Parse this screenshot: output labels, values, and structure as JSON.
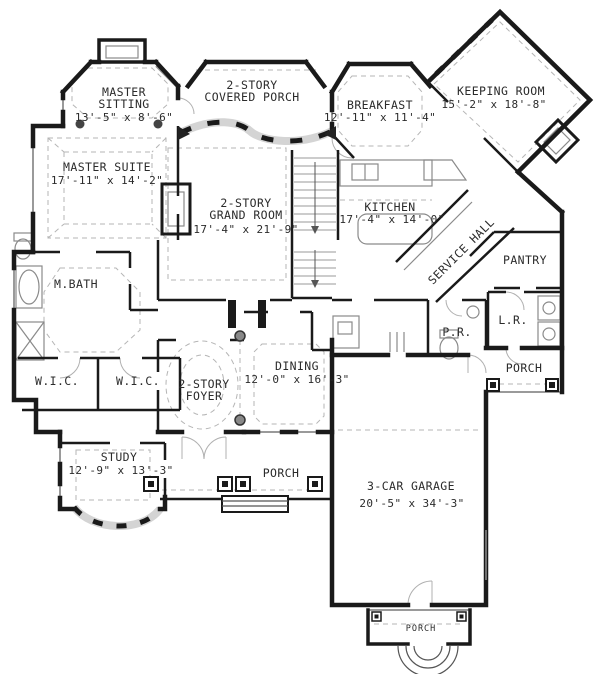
{
  "plan": {
    "type": "first-floor-house-plan",
    "rooms": {
      "master_sitting": {
        "line1": "MASTER",
        "line2": "SITTING",
        "dims": "13'-5\" x 8'-6\""
      },
      "master_suite": {
        "name": "MASTER SUITE",
        "dims": "17'-11\" x 14'-2\""
      },
      "covered_porch": {
        "line1": "2-STORY",
        "line2": "COVERED PORCH"
      },
      "breakfast": {
        "name": "BREAKFAST",
        "dims": "12'-11\" x 11'-4\""
      },
      "keeping_room": {
        "name": "KEEPING ROOM",
        "dims": "15'-2\" x 18'-8\""
      },
      "grand_room": {
        "line1": "2-STORY",
        "line2": "GRAND ROOM",
        "dims": "17'-4\" x 21'-9\""
      },
      "kitchen": {
        "name": "KITCHEN",
        "dims": "17'-4\" x 14'-0\""
      },
      "service_hall": {
        "name": "SERVICE HALL"
      },
      "pantry": {
        "name": "PANTRY"
      },
      "master_bath": {
        "name": "M.BATH"
      },
      "wic_left": {
        "name": "W.I.C."
      },
      "wic_right": {
        "name": "W.I.C."
      },
      "dining": {
        "name": "DINING",
        "dims": "12'-0\" x 16'-3\""
      },
      "foyer": {
        "line1": "2-STORY",
        "line2": "FOYER"
      },
      "study": {
        "name": "STUDY",
        "dims": "12'-9\" x 13'-3\""
      },
      "powder_room": {
        "name": "P.R."
      },
      "laundry": {
        "name": "L.R."
      },
      "porch_front": {
        "name": "PORCH"
      },
      "porch_side": {
        "name": "PORCH"
      },
      "porch_rear": {
        "name": "PORCH"
      },
      "garage": {
        "name": "3-CAR GARAGE",
        "dims": "20'-5\" x 34'-3\""
      }
    },
    "colors": {
      "wall": "#1a1a1a",
      "window": "#9a9a9a",
      "dashed_ceiling": "#b5b5b5",
      "fixture": "#8a8a8a"
    }
  }
}
